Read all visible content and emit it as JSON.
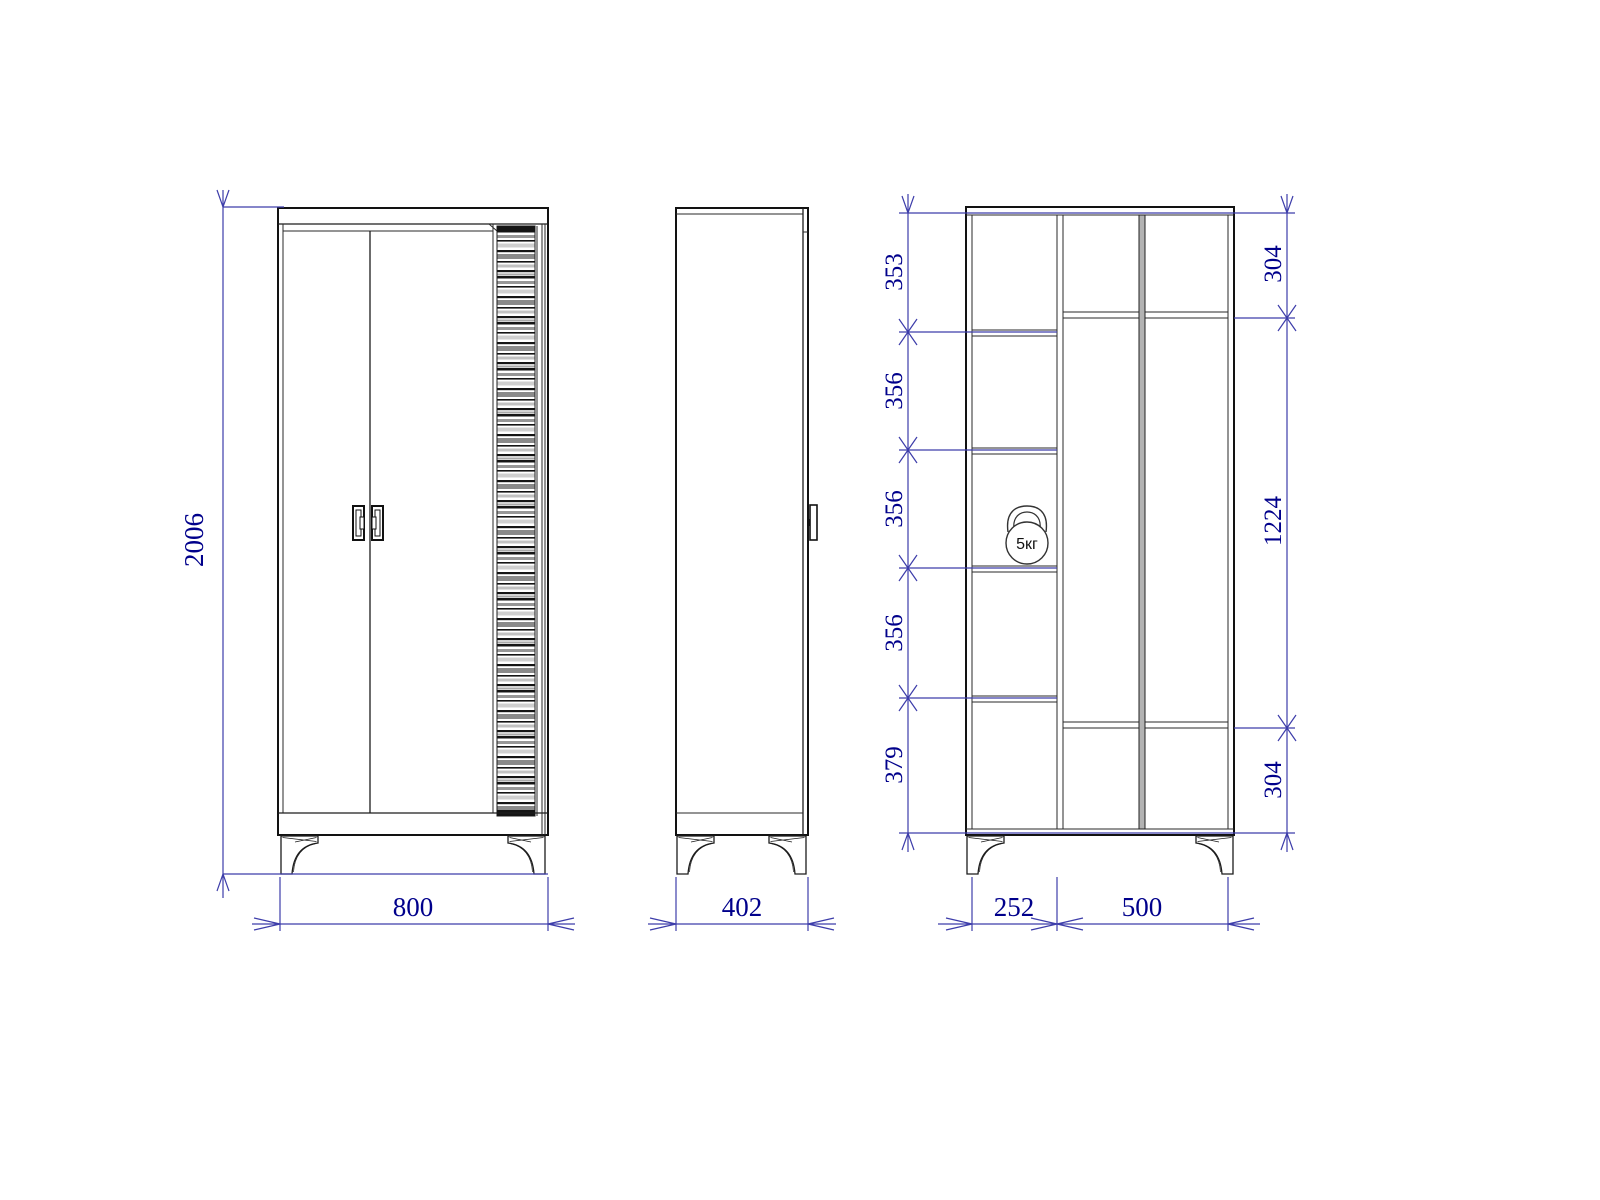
{
  "front_view": {
    "height_mm": "2006",
    "width_mm": "800"
  },
  "side_view": {
    "depth_mm": "402"
  },
  "section_view": {
    "shelf_heights_left": [
      "353",
      "356",
      "356",
      "356",
      "379"
    ],
    "heights_right": [
      "304",
      "1224",
      "304"
    ],
    "widths_bottom": [
      "252",
      "500"
    ],
    "weight_capacity": "5кг"
  },
  "colors": {
    "dimension_line": "#3d3daa",
    "dimension_text": "#00008b",
    "drawing_line": "#1c1c1c"
  }
}
